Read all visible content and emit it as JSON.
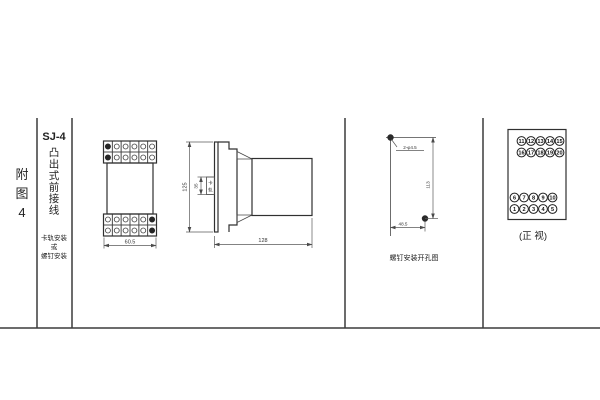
{
  "sidebar": {
    "figure_label_chars": [
      "附",
      "图",
      "4"
    ],
    "model": "SJ-4",
    "type_chars": [
      "凸",
      "出",
      "式",
      "前",
      "接",
      "线"
    ],
    "mount_lines": [
      "卡轨安装",
      "或",
      "螺钉安装"
    ]
  },
  "front_view": {
    "width_dim": "60.5"
  },
  "side_view": {
    "height_dim": "125",
    "rail_width_dim": "35",
    "rail_label_chars": [
      "卡",
      "轨"
    ],
    "depth_dim": "128"
  },
  "drill_view": {
    "holes_label": "2-φ4.5",
    "vertical_dim": "113",
    "horizontal_dim": "48.5",
    "caption": "螺钉安装开孔图"
  },
  "terminal_view": {
    "rows": [
      [
        "11",
        "12",
        "13",
        "14",
        "15"
      ],
      [
        "16",
        "17",
        "18",
        "19",
        "20"
      ],
      [
        "6",
        "7",
        "8",
        "9",
        "10"
      ],
      [
        "1",
        "2",
        "3",
        "4",
        "5"
      ]
    ],
    "caption": "(正 视)"
  },
  "colors": {
    "line": "#3c3c3c",
    "background": "#ffffff"
  }
}
